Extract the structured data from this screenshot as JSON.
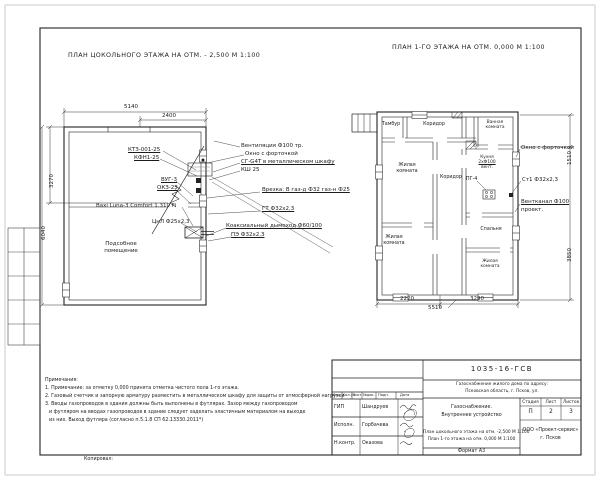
{
  "titles": {
    "left": "ПЛАН ЦОКОЛЬНОГО ЭТАЖА НА ОТМ. - 2,500 М 1:100",
    "right": "ПЛАН 1-ГО ЭТАЖА НА ОТМ. 0,000 М 1:100"
  },
  "basement": {
    "room_w1": "Подсобное",
    "room_w2": "помещение",
    "labels": {
      "l1": "КТЗ-001-25",
      "l2": "КФН1-25",
      "l3": "ВУГ-3",
      "l4": "ОКЗ-25",
      "boiler": "Baxi Luna-3 Comfort 1.310 Fi",
      "pipe": "ЦнЛ Ф25х2,3"
    },
    "callouts": {
      "c1": "Вентиляция Ф100 тр.",
      "c2": "Окно с форточкой",
      "c3": "СГ-G4Т в металлическом шкафу",
      "c4": "КШ 25",
      "c5": "Врезка: В газ-д Ф32  газ-н Ф25",
      "c6": "ГТ Ф32х2,3",
      "c7": "Коаксиальный дымоход Ф60/100",
      "c8": "ПЭ Ф32х2,3"
    },
    "dims": {
      "top": "5140",
      "top_sub": "2400",
      "left": "6040",
      "left_sub": "3270"
    }
  },
  "floor1": {
    "rooms": {
      "tambur": "Тамбур",
      "corridor": "Коридор",
      "bath_w1": "Ванная",
      "bath_w2": "комната",
      "living_w1": "Жилая",
      "living_w2": "комната",
      "bedroom": "Спальня",
      "kitchen_l1": "Кухня",
      "kitchen_l2": "2хФ100",
      "kitchen_l3": "вент.",
      "stove": "ПГ-4"
    },
    "callouts": {
      "c1": "Окно с форточкой",
      "c2": "Ст1 Ф32х2,3",
      "c3": "Вентканал Ф100",
      "c4": "проект."
    },
    "dims": {
      "b1": "2220",
      "b2": "3290",
      "total": "5510",
      "r1": "1510",
      "r2": "3850"
    }
  },
  "notes": {
    "title": "Примечания:",
    "n1": "1. Примечание: за отметку 0,000 принята отметка чистого пола 1-го этажа.",
    "n2": "2. Газовый счетчик и запорную арматуру разместить в металлическом шкафу для защиты от атмосферной нагрузки",
    "n3": "3. Вводы газопроводов в здания должны быть выполнены в футлярах. Зазор между газопроводом",
    "n4": "и футляром на вводах газопроводов в здание следует заделать эластичным материалом на выходе",
    "n5": "из них. Выход футляра (согласно п.5.1.8 СП 62.13330.2011*)"
  },
  "titleblock": {
    "doc_number": "1035-16-ГСВ",
    "object_line1": "Газоснабжение жилого дома по адресу:",
    "object_line2": "Псковская область, г. Псков, ул.",
    "section_line1": "Газоснабжение.",
    "section_line2": "Внутреннее устройство",
    "content_line1": "План цокольного этажа на отм. -2,500 М 1:100",
    "content_line2": "План 1-го этажа на отм. 0,000 М 1:100",
    "stage_label": "Стадия",
    "sheet_label": "Лист",
    "sheets_label": "Листов",
    "stage": "П",
    "sheet": "2",
    "sheets": "3",
    "company_line1": "ООО «Проект-сервис»",
    "company_line2": "г. Псков",
    "cols": {
      "izm": "Изм.",
      "koluch": "Кол.уч",
      "list": "Лист",
      "ndok": "№док.",
      "podp": "Подп.",
      "data": "Дата"
    },
    "rows": {
      "r1l": "ГИП",
      "r1n": "Шандруев",
      "r2l": "Исполн.",
      "r2n": "Горбачева",
      "r3l": "Н.контр.",
      "r3n": "Оказова"
    },
    "format": "Формат А3",
    "kopiroval": "Копировал:"
  }
}
